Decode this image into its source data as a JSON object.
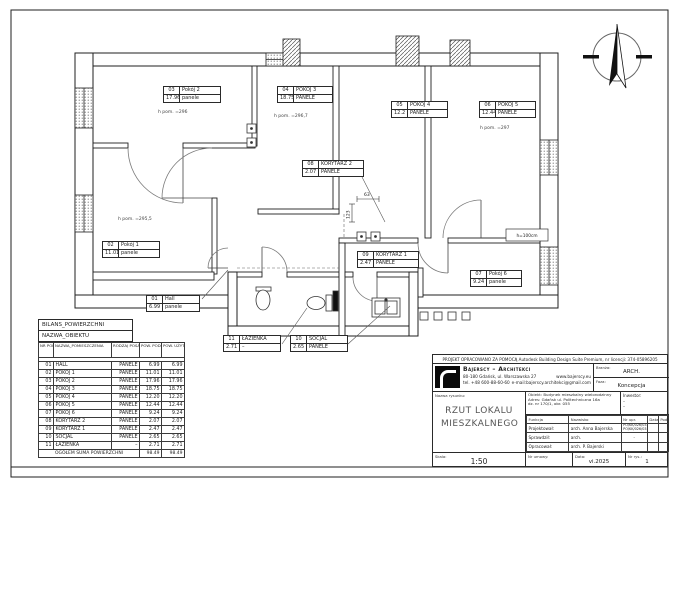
{
  "colors": {
    "line": "#1f1f1f",
    "paper": "#ffffff"
  },
  "plan": {
    "labels": [
      {
        "nr": "03",
        "name": "Pokój 2",
        "area": "17.96",
        "floor": "panele"
      },
      {
        "nr": "04",
        "name": "POKÓJ 3",
        "area": "18.75",
        "floor": "PANELE"
      },
      {
        "nr": "05",
        "name": "POKÓJ 4",
        "area": "12.2",
        "floor": "PANELE"
      },
      {
        "nr": "06",
        "name": "POKÓJ 5",
        "area": "12.44",
        "floor": "PANELE"
      },
      {
        "nr": "08",
        "name": "KORYTARZ 2",
        "area": "2.07",
        "floor": "PANELE"
      },
      {
        "nr": "02",
        "name": "Pokój 1",
        "area": "11.01",
        "floor": "panele"
      },
      {
        "nr": "09",
        "name": "KORYTARZ 1",
        "area": "2.47",
        "floor": "PANELE"
      },
      {
        "nr": "07",
        "name": "Pokój 6",
        "area": "9.24",
        "floor": "panele"
      },
      {
        "nr": "01",
        "name": "Hall",
        "area": "6.99",
        "floor": "panele"
      },
      {
        "nr": "11",
        "name": "ŁAZIENKA",
        "area": "2.71",
        "floor": "–"
      },
      {
        "nr": "10",
        "name": "SOCJAL",
        "area": "2.65",
        "floor": "PANELE"
      }
    ],
    "height_notes": [
      "h pom. =296",
      "h pom. =296,7",
      "h pom. =295,5",
      "h pom. =297"
    ],
    "dims": [
      "63",
      "123"
    ],
    "wall_note": "h=100cm"
  },
  "area_table": {
    "title": "BILANS_POWIERZCHNI",
    "subtitle": "NAZWA_OBIEKTU",
    "columns": [
      "NR POM.",
      "NAZWA_POMIESZCZENIA",
      "RODZAJ POSADZKI",
      "POW. PODŁOGI",
      "POW. UŻYTKOWA"
    ],
    "rows": [
      [
        "01",
        "HALL",
        "PANELE",
        "6.99",
        "6.99"
      ],
      [
        "02",
        "POKÓJ 1",
        "PANELE",
        "11.01",
        "11.01"
      ],
      [
        "03",
        "POKÓJ 2",
        "PANELE",
        "17.96",
        "17.96"
      ],
      [
        "04",
        "POKÓJ 3",
        "PANELE",
        "18.75",
        "18.75"
      ],
      [
        "05",
        "POKÓJ 4",
        "PANELE",
        "12.20",
        "12.20"
      ],
      [
        "06",
        "POKÓJ 5",
        "PANELE",
        "12.44",
        "12.44"
      ],
      [
        "07",
        "POKÓJ 6",
        "PANELE",
        "9.24",
        "9.24"
      ],
      [
        "08",
        "KORYTARZ 2",
        "PANELE",
        "2.07",
        "2.07"
      ],
      [
        "09",
        "KORYTARZ 1",
        "PANELE",
        "2.47",
        "2.47"
      ],
      [
        "10",
        "SOCJAL",
        "PANELE",
        "2.65",
        "2.65"
      ],
      [
        "11",
        "ŁAZIENKA",
        "–",
        "2.71",
        "2.71"
      ]
    ],
    "footer": [
      "OGÓŁEM SUMA POWIERZCHNI",
      "98.49",
      "98.49"
    ]
  },
  "titleblock": {
    "license_line": "PROJEKT OPRACOWANO ZA POMOCĄ Autodesk Building Design Suite Premium, nr licencji: 374-05896205",
    "firm": {
      "name": "Bajerscy – Architekci",
      "address": "80-180 Gdańsk, ul. Warszawska 27",
      "phone": "tel. +48 600-88-60-60",
      "www": "www.bajerscy.eu",
      "email": "e-mail:bajerscy.architekci@gmail.com"
    },
    "branza_label": "Branża:",
    "branza_value": "ARCH.",
    "faza_label": "Faza:",
    "faza_value": "Koncepcja",
    "drawing_label": "Nazwa rysunku:",
    "drawing_title": "RZUT LOKALU MIESZKALNEGO",
    "obiekt_label": "Obiekt:",
    "obiekt_value": "Budynek mieszkalny wielorodzinny",
    "adres_label": "Adres:",
    "adres_value": "Gdańsk ul. Politechniczna 16a",
    "adres_value2": "dz. nr 170/1, obr. 055",
    "inwestor_label": "Inwestor:",
    "inwestor_value1": "–",
    "inwestor_value2": "–",
    "personnel_headers": [
      "Funkcja",
      "Nazwisko",
      "Nr upr.",
      "Data",
      "Podpis"
    ],
    "personnel_rows": [
      [
        "Projektował:",
        "arch. Anna Bajerska",
        "PO/KK/026/03\nPO/KK/026/03",
        "",
        ""
      ],
      [
        "Sprawdził:",
        "arch.",
        "–",
        "",
        ""
      ],
      [
        "Opracował:",
        "arch. P. Bajerski",
        "",
        "",
        ""
      ]
    ],
    "skala_label": "Skala:",
    "skala_value": "1:50",
    "umowa_label": "Nr umowy:",
    "umowa_value": "",
    "data_label": "Data:",
    "data_value": "vi.2025",
    "rys_label": "Nr rys.:",
    "rys_value": "1"
  }
}
